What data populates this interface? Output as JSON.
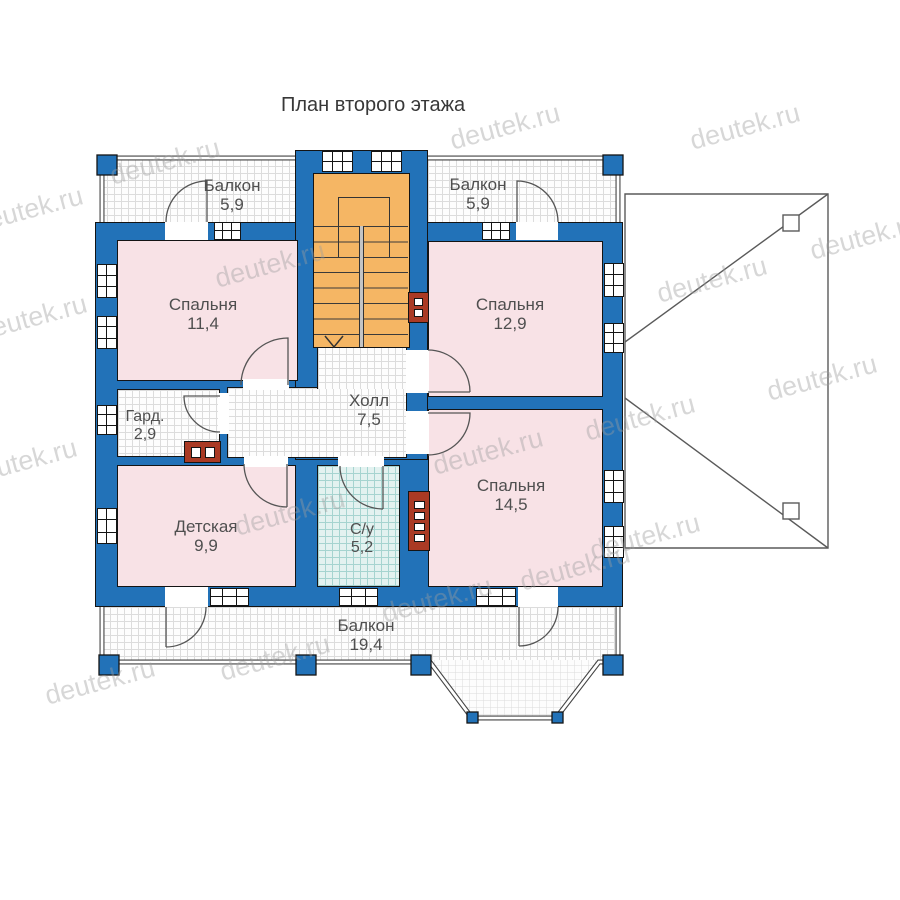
{
  "title": "План второго этажа",
  "watermark": {
    "text": "deutek.ru"
  },
  "rooms": {
    "balcony_top_left": {
      "name": "Балкон",
      "area": "5,9"
    },
    "balcony_top_right": {
      "name": "Балкон",
      "area": "5,9"
    },
    "bedroom_left": {
      "name": "Спальня",
      "area": "11,4"
    },
    "bedroom_right": {
      "name": "Спальня",
      "area": "12,9"
    },
    "wardrobe": {
      "name": "Гард.",
      "area": "2,9"
    },
    "hall": {
      "name": "Холл",
      "area": "7,5"
    },
    "nursery": {
      "name": "Детская",
      "area": "9,9"
    },
    "bathroom": {
      "name": "С/у",
      "area": "5,2"
    },
    "bedroom_master": {
      "name": "Спальня",
      "area": "14,5"
    },
    "balcony_bottom": {
      "name": "Балкон",
      "area": "19,4"
    }
  },
  "colors": {
    "wall_blue": "#2272b8",
    "room_pink": "#f8e2e6",
    "stairs_orange": "#f5b664",
    "bathroom_tile": "#e3f2f0",
    "vent_red": "#aa3a24",
    "floor_grid_line": "#dcdcdc",
    "outline": "#141414",
    "label_text": "#4f4f4f"
  }
}
